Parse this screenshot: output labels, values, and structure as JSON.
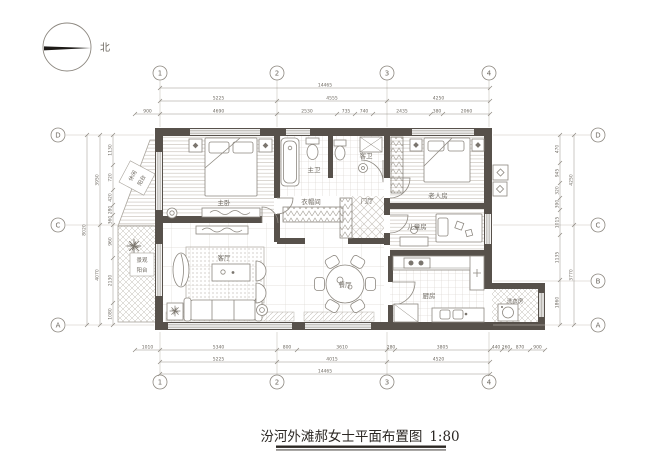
{
  "title": {
    "text": "汾河外滩郝女士平面布置图",
    "scale": "1:80"
  },
  "compass": {
    "north_label": "北"
  },
  "grid": {
    "top": [
      "1",
      "2",
      "3",
      "4"
    ],
    "bottom": [
      "1",
      "2",
      "3",
      "4"
    ],
    "left": [
      "D",
      "C",
      "A"
    ],
    "right": [
      "D",
      "C",
      "B",
      "A"
    ]
  },
  "rooms": {
    "master_bedroom": "主卧",
    "master_bath": "主卫",
    "guest_bath": "客卫",
    "closet": "衣帽间",
    "foyer": "门厅",
    "elder_room": "老人房",
    "kids_room": "儿童房",
    "living_room": "客厅",
    "dining_room": "餐厅",
    "kitchen": "厨房",
    "laundry": "洗衣房",
    "leisure_balcony_line1": "休闲",
    "leisure_balcony_line2": "阳台",
    "view_balcony_line1": "景观",
    "view_balcony_line2": "阳台"
  },
  "dims": {
    "top_total": [
      "14465"
    ],
    "top_mid": [
      "5225",
      "4555",
      "4250"
    ],
    "top_inner": [
      "900",
      "4690",
      "2530",
      "735",
      "740",
      "2435",
      "380",
      "2060"
    ],
    "bottom_inner": [
      "1010",
      "5340",
      "800",
      "3610",
      "280",
      "3805",
      "440",
      "260",
      "870",
      "900"
    ],
    "bottom_mid": [
      "5225",
      "4015",
      "4520"
    ],
    "bottom_total": [
      "14465"
    ],
    "left_inner": [
      "1130",
      "720",
      "420",
      "280",
      "360",
      "960",
      "2130",
      "1080"
    ],
    "left_mid": [
      "3950",
      "4070"
    ],
    "left_total": [
      "8020"
    ],
    "right_inner": [
      "470",
      "945",
      "320",
      "390",
      "1015",
      "1135",
      "1860"
    ],
    "right_mid": [
      "4250",
      "3770"
    ]
  },
  "colors": {
    "wall": "#57514b",
    "line": "#8d8880",
    "line_light": "#c9c4bd",
    "dim_text": "#8d8880",
    "label_text": "#6e6961",
    "title_text": "#2b2723",
    "background": "#ffffff"
  }
}
